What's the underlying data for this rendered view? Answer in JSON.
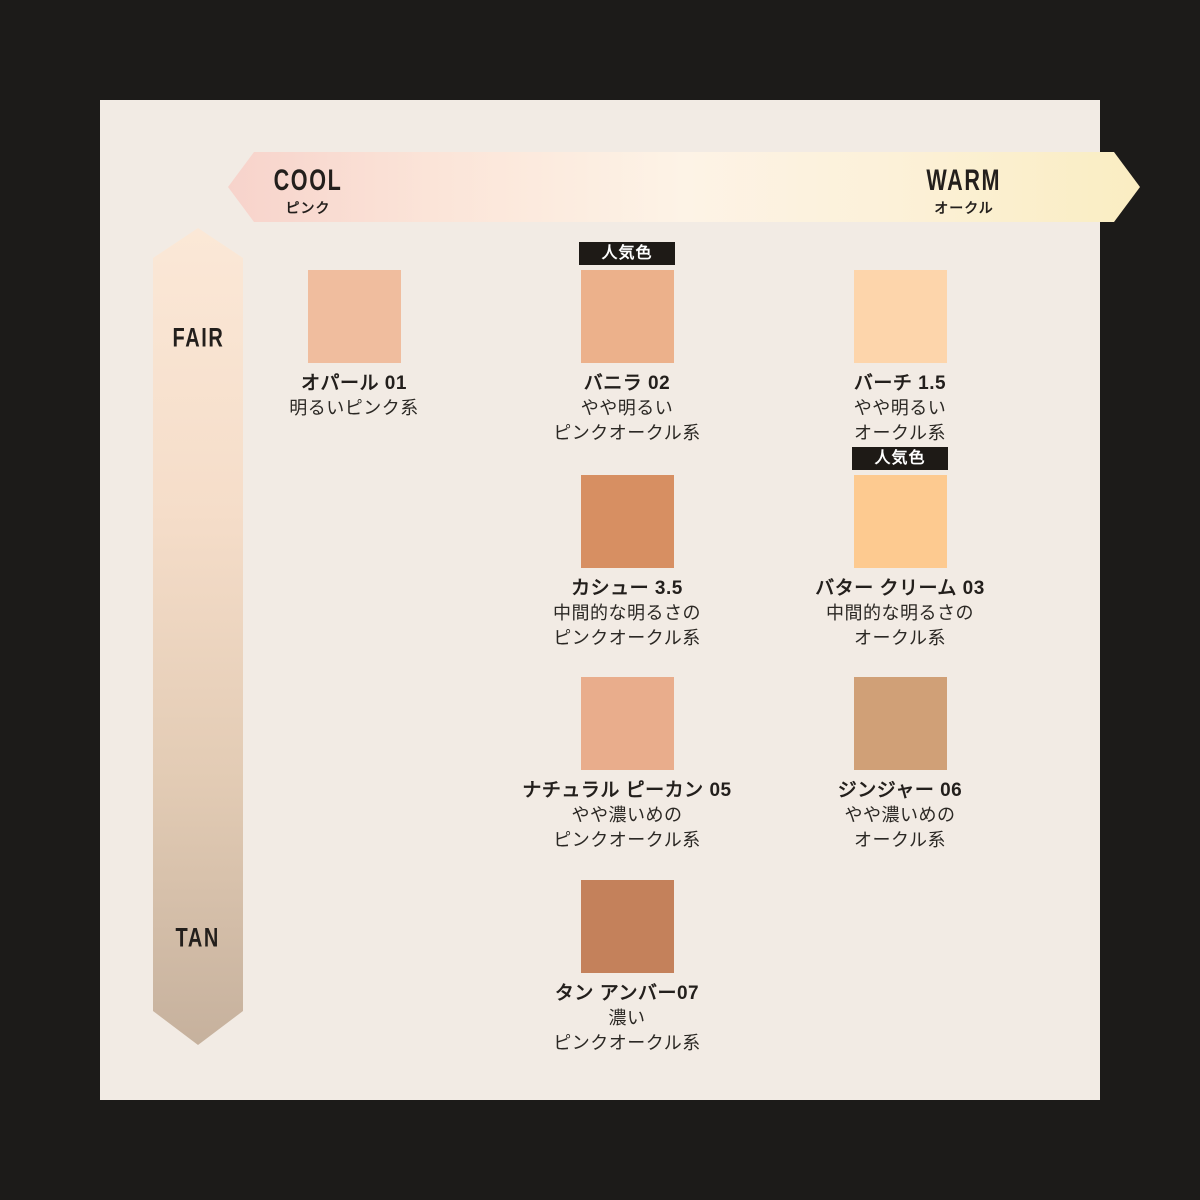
{
  "colors": {
    "frame": "#1c1b19",
    "panel": "#f2ebe4",
    "badge_bg": "#1e1a16",
    "badge_text": "#ffffff",
    "text": "#231f1c"
  },
  "badge": {
    "label": "人気色"
  },
  "axis_h": {
    "label_left": "COOL",
    "sub_left": "ピンク",
    "label_right": "WARM",
    "sub_right": "オークル",
    "gradient": [
      "#f7d3cb",
      "#fbe4d8",
      "#fdf3e6",
      "#fcf1d9",
      "#faedc2"
    ]
  },
  "axis_v": {
    "label_top": "FAIR",
    "label_bottom": "TAN",
    "gradient": [
      "#fbe8d7",
      "#f5ddc9",
      "#e2cbb4",
      "#c6b19d"
    ]
  },
  "shades": [
    {
      "name": "オパール 01",
      "desc": [
        "明るいピンク系"
      ],
      "color": "#f0bd9e",
      "popular": false,
      "col": 1,
      "row": 1
    },
    {
      "name": "バニラ 02",
      "desc": [
        "やや明るい",
        "ピンクオークル系"
      ],
      "color": "#ecb18b",
      "popular": true,
      "col": 2,
      "row": 1
    },
    {
      "name": "バーチ 1.5",
      "desc": [
        "やや明るい",
        "オークル系"
      ],
      "color": "#fdd5ab",
      "popular": false,
      "col": 3,
      "row": 1
    },
    {
      "name": "カシュー 3.5",
      "desc": [
        "中間的な明るさの",
        "ピンクオークル系"
      ],
      "color": "#d78f62",
      "popular": false,
      "col": 2,
      "row": 2
    },
    {
      "name": "バター クリーム 03",
      "desc": [
        "中間的な明るさの",
        "オークル系"
      ],
      "color": "#fdca90",
      "popular": true,
      "col": 3,
      "row": 2
    },
    {
      "name": "ナチュラル ピーカン 05",
      "desc": [
        "やや濃いめの",
        "ピンクオークル系"
      ],
      "color": "#e9ad8c",
      "popular": false,
      "col": 2,
      "row": 3
    },
    {
      "name": "ジンジャー 06",
      "desc": [
        "やや濃いめの",
        "オークル系"
      ],
      "color": "#d0a077",
      "popular": false,
      "col": 3,
      "row": 3
    },
    {
      "name": "タン アンバー07",
      "desc": [
        "濃い",
        "ピンクオークル系"
      ],
      "color": "#c4815b",
      "popular": false,
      "col": 2,
      "row": 4
    }
  ]
}
